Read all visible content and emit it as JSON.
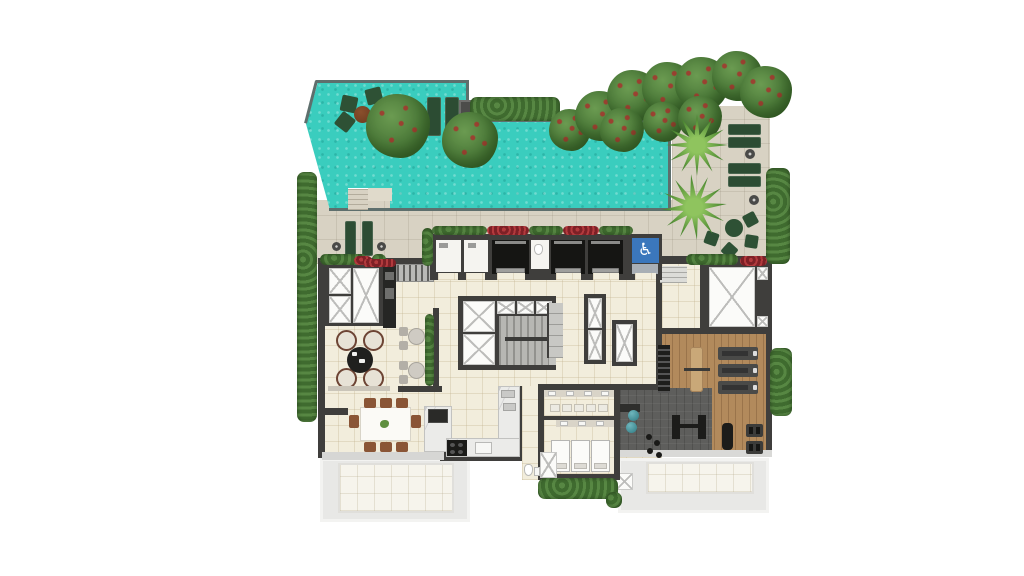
{
  "meta": {
    "kind": "architectural floor plan (top-down render)",
    "description": "Rooftop amenity floor plan: swimming pool with deck, landscaped gardens with palms, lounge seating, barbecue counter, kitchen and dining room, elevator bank with stairs, changing rooms with showers, and a gym with wood and rubber flooring",
    "visible_text": []
  },
  "icons": {
    "accessibility_glyph": "♿",
    "accessibility_name": "wheelchair-accessible-icon"
  },
  "palette": {
    "pool": "#3ACDBE",
    "pool-edge": "#5E6F6D",
    "deck": "#D8D2C3",
    "floor": "#F2EDDC",
    "wall": "#3F3E3C",
    "wall-light": "#D6D6D4",
    "wood": "#B28A5C",
    "mat": "#5E5E5C",
    "terrace": "#E8E8E6",
    "terrace-tile": "#F6F4EC",
    "hedge": "#477436",
    "flower": "#9C2F33",
    "lounger": "#2C4C33",
    "chair-wood": "#8A5536",
    "accent-blue": "#3B77BC"
  },
  "inventory": {
    "elevators": 3,
    "stair_cores": 1,
    "in_pool_loungers": 2,
    "deck_loungers": 2,
    "garden_loungers": 4,
    "palm_trees": 2,
    "treadmills": 3,
    "shower_stalls": 3,
    "dining_chairs": 8,
    "lounge_chairs": 4
  }
}
